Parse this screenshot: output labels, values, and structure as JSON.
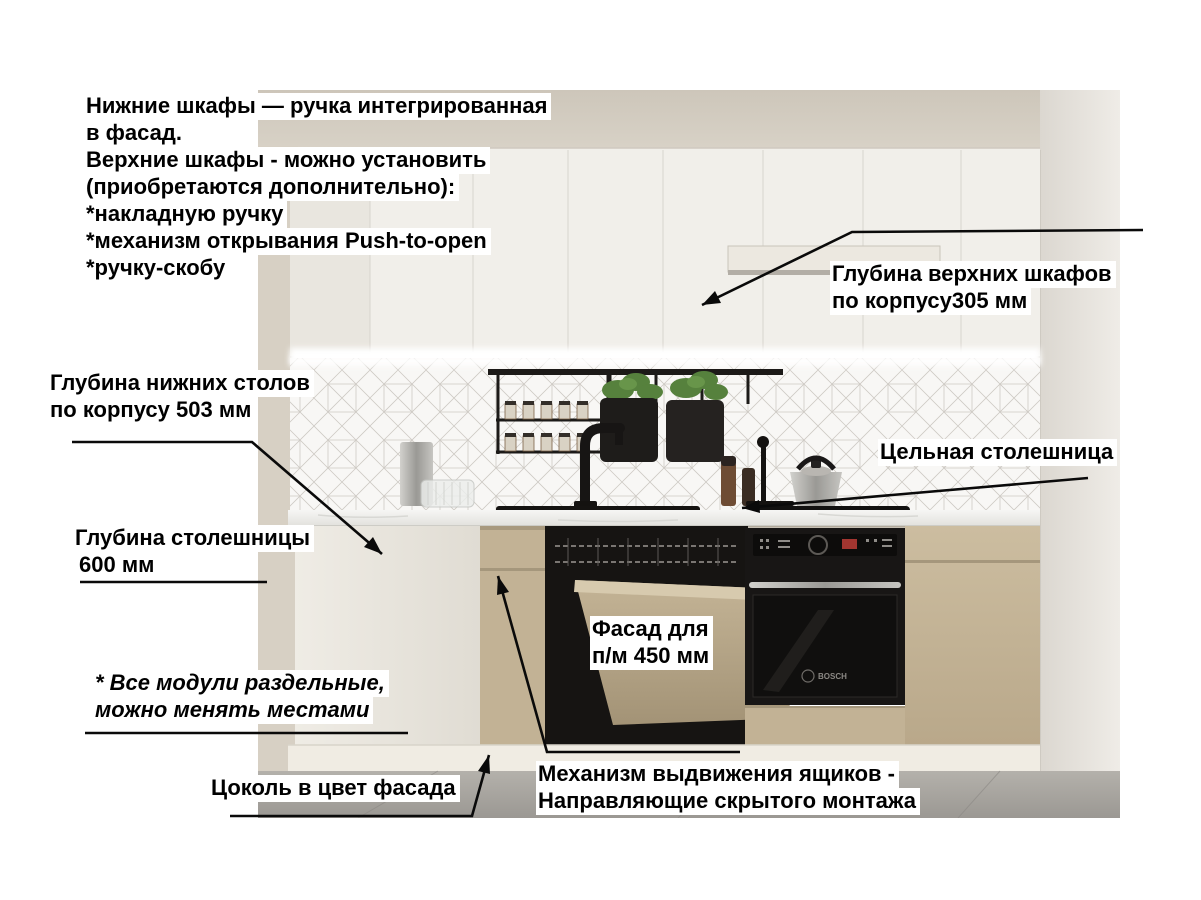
{
  "image": {
    "description": "kitchen-render-infographic",
    "brand_on_oven": "BOSCH"
  },
  "colors": {
    "label_background": "#ffffff",
    "label_text": "#000000",
    "arrow": "#0a0a0a",
    "upper_cabinets_white": "#f1efea",
    "lower_facade_beige": "#c2b295",
    "countertop_white": "#f2f2ef",
    "plinth_white": "#f0ece3",
    "floor_grey": "#a8a5a0"
  },
  "annotations": {
    "handles_note": {
      "lines": [
        "Нижние шкафы — ручка интегрированная",
        "в фасад.",
        "Верхние шкафы - можно установить",
        "(приобретаются дополнительно):",
        "*накладную ручку",
        "*механизм открывания Push-to-open",
        "*ручку-скобу"
      ]
    },
    "upper_depth": {
      "line1": "Глубина верхних шкафов",
      "line2": "по корпусу305 мм"
    },
    "base_depth": {
      "line1": "Глубина нижних столов",
      "line2": "по корпусу 503 мм"
    },
    "countertop_depth": {
      "line1": "Глубина столешницы",
      "line2": "600 мм"
    },
    "solid_countertop": {
      "text": "Цельная столешница"
    },
    "dishwasher_front": {
      "line1": "Фасад для",
      "line2": "п/м 450 мм"
    },
    "modules_note": {
      "line1": "* Все модули раздельные,",
      "line2": "можно менять местами"
    },
    "plinth": {
      "text": "Цоколь в цвет фасада"
    },
    "drawer_mechanism": {
      "line1": "Механизм выдвижения ящиков -",
      "line2": "Направляющие скрытого монтажа"
    }
  }
}
